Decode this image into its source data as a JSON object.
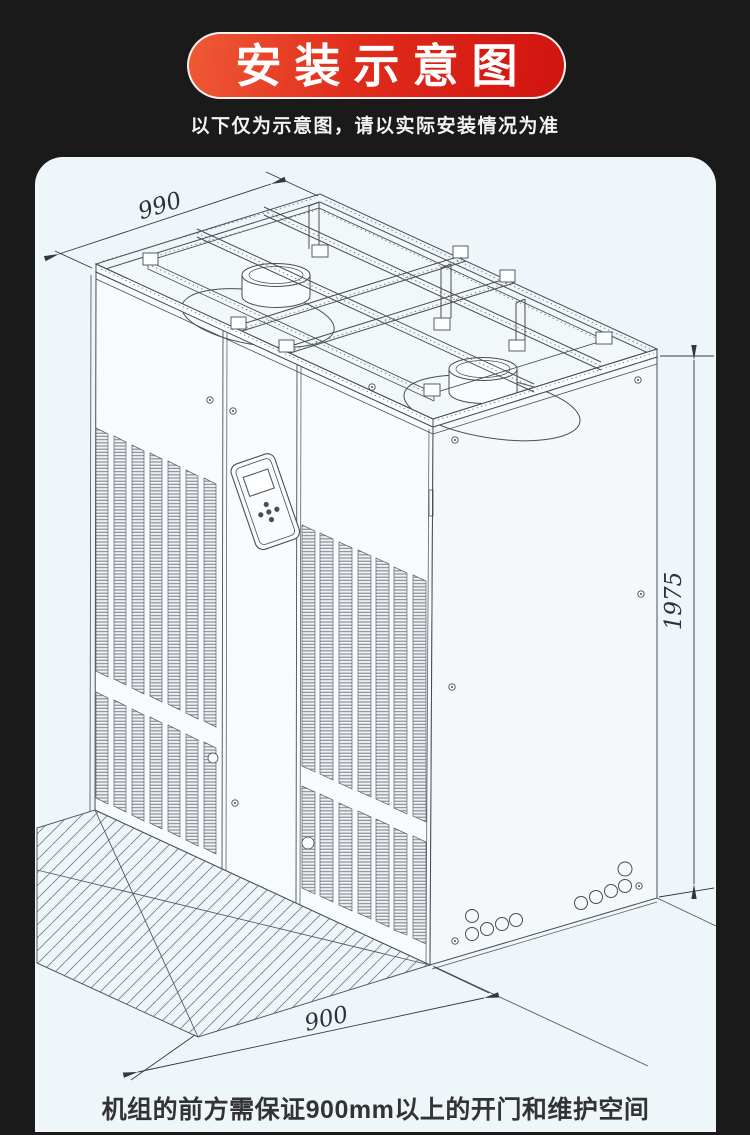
{
  "page": {
    "background_color": "#1a1a1b",
    "panel_background_color": "#eff6fa"
  },
  "header": {
    "badge_label": "安装示意图",
    "badge_gradient_start": "#ef5a36",
    "badge_gradient_end": "#d01410",
    "subtitle": "以下仅为示意图，请以实际安装情况为准"
  },
  "diagram": {
    "dimension_depth_mm": "990",
    "dimension_height_mm": "1975",
    "dimension_clearance_mm": "900",
    "caption": "机组的前方需保证900mm以上的开门和维护空间"
  }
}
